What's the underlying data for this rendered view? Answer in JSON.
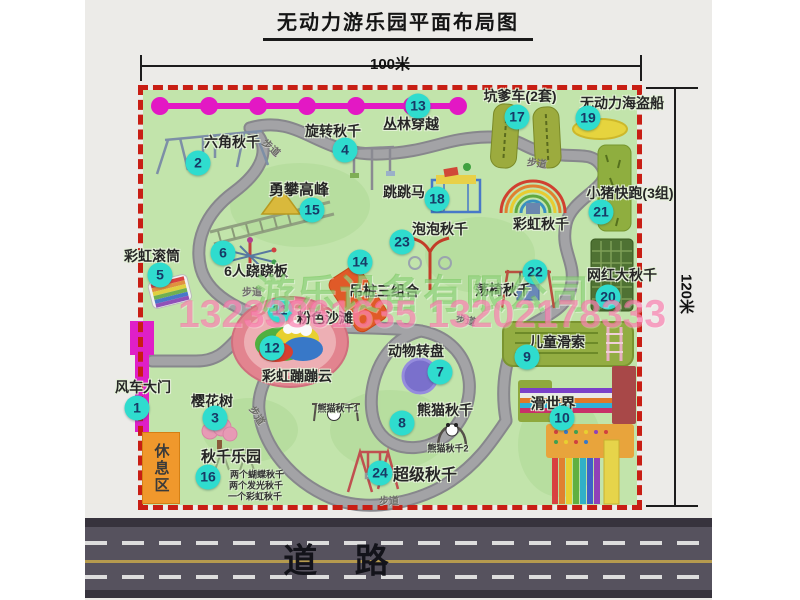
{
  "title": "无动力游乐园平面布局图",
  "dimensions": {
    "width_label": "100米",
    "height_label": "120米"
  },
  "road": {
    "label": "道  路"
  },
  "watermark": {
    "company": "游乐设备有限公司",
    "phone": "13233861635 13202178333"
  },
  "rest_area": {
    "label": "休息区"
  },
  "colors": {
    "badge": "#2fdcce",
    "border": "#c81e14",
    "grass": "#c2e4ab",
    "gate": "#df1fc7",
    "road": "#56525e"
  },
  "map": {
    "attractions": [
      {
        "num": "1",
        "name": "风车大门",
        "badge": [
          137,
          408
        ],
        "label": [
          143,
          387
        ]
      },
      {
        "num": "2",
        "name": "六角秋千",
        "badge": [
          198,
          163
        ],
        "label": [
          232,
          142
        ]
      },
      {
        "num": "3",
        "name": "樱花树",
        "badge": [
          215,
          418
        ],
        "label": [
          212,
          401
        ]
      },
      {
        "num": "4",
        "name": "旋转秋千",
        "badge": [
          345,
          150
        ],
        "label": [
          333,
          131
        ]
      },
      {
        "num": "5",
        "name": "彩虹滚筒",
        "badge": [
          160,
          275
        ],
        "label": [
          152,
          256
        ]
      },
      {
        "num": "6",
        "name": "6人跷跷板",
        "badge": [
          223,
          253
        ],
        "label": [
          256,
          271
        ]
      },
      {
        "num": "7",
        "name": "动物转盘",
        "badge": [
          440,
          372
        ],
        "label": [
          416,
          351
        ]
      },
      {
        "num": "8",
        "name": "熊猫秋千",
        "badge": [
          402,
          423
        ],
        "label": [
          445,
          410
        ]
      },
      {
        "num": "9",
        "name": "儿童滑索",
        "badge": [
          527,
          357
        ],
        "label": [
          557,
          342
        ]
      },
      {
        "num": "10",
        "name": "滑世界",
        "badge": [
          562,
          418
        ],
        "label": [
          553,
          403
        ],
        "fs": 15
      },
      {
        "num": "11",
        "name": "粉色沙滩",
        "badge": [
          280,
          310
        ],
        "label": [
          325,
          318
        ]
      },
      {
        "num": "12",
        "name": "彩虹蹦蹦云",
        "badge": [
          272,
          348
        ],
        "label": [
          297,
          376
        ]
      },
      {
        "num": "13",
        "name": "丛林穿越",
        "badge": [
          418,
          106
        ],
        "label": [
          411,
          124
        ]
      },
      {
        "num": "14",
        "name": "吊桩三组合",
        "badge": [
          360,
          262
        ],
        "label": [
          384,
          291
        ]
      },
      {
        "num": "15",
        "name": "勇攀高峰",
        "badge": [
          312,
          210
        ],
        "label": [
          299,
          189
        ],
        "fs": 15
      },
      {
        "num": "16",
        "name": "秋千乐园",
        "badge": [
          208,
          477
        ],
        "label": [
          231,
          456
        ],
        "fs": 15
      },
      {
        "num": "17",
        "name": "坑爹车(2套)",
        "badge": [
          517,
          117
        ],
        "label": [
          520,
          96
        ]
      },
      {
        "num": "18",
        "name": "跳跳马",
        "badge": [
          437,
          199
        ],
        "label": [
          404,
          192
        ]
      },
      {
        "num": "19",
        "name": "无动力海盗船",
        "badge": [
          588,
          118
        ],
        "label": [
          622,
          103
        ]
      },
      {
        "num": "20",
        "name": "网红大秋千",
        "badge": [
          608,
          297
        ],
        "label": [
          622,
          275
        ]
      },
      {
        "num": "21",
        "name": "小猪快跑(3组)",
        "badge": [
          601,
          212
        ],
        "label": [
          630,
          193
        ]
      },
      {
        "num": "22",
        "name": "荡椅秋千",
        "badge": [
          535,
          272
        ],
        "label": [
          503,
          290
        ]
      },
      {
        "num": "23",
        "name": "泡泡秋千",
        "badge": [
          402,
          242
        ],
        "label": [
          440,
          229
        ]
      },
      {
        "num": "24",
        "name": "超级秋千",
        "badge": [
          380,
          473
        ],
        "label": [
          425,
          473
        ],
        "fs": 16
      },
      {
        "num": null,
        "name": "彩虹秋千",
        "badge": null,
        "label": [
          541,
          224
        ]
      }
    ],
    "sub_labels": [
      {
        "text": "熊猫秋千1",
        "pos": [
          338,
          408
        ]
      },
      {
        "text": "熊猫秋千2",
        "pos": [
          448,
          448
        ]
      },
      {
        "text": "两个蝴蝶秋千",
        "pos": [
          257,
          474
        ]
      },
      {
        "text": "两个发光秋千",
        "pos": [
          256,
          485
        ]
      },
      {
        "text": "一个彩虹秋千",
        "pos": [
          255,
          496
        ]
      }
    ],
    "path_labels": [
      {
        "text": "步道",
        "pos": [
          272,
          147
        ],
        "rot": 42
      },
      {
        "text": "步道",
        "pos": [
          537,
          162
        ],
        "rot": 8
      },
      {
        "text": "步道",
        "pos": [
          252,
          291
        ],
        "rot": 0
      },
      {
        "text": "步道",
        "pos": [
          466,
          319
        ],
        "rot": 12
      },
      {
        "text": "步道",
        "pos": [
          389,
          500
        ],
        "rot": 0
      },
      {
        "text": "步道",
        "pos": [
          258,
          415
        ],
        "rot": 58
      }
    ]
  }
}
